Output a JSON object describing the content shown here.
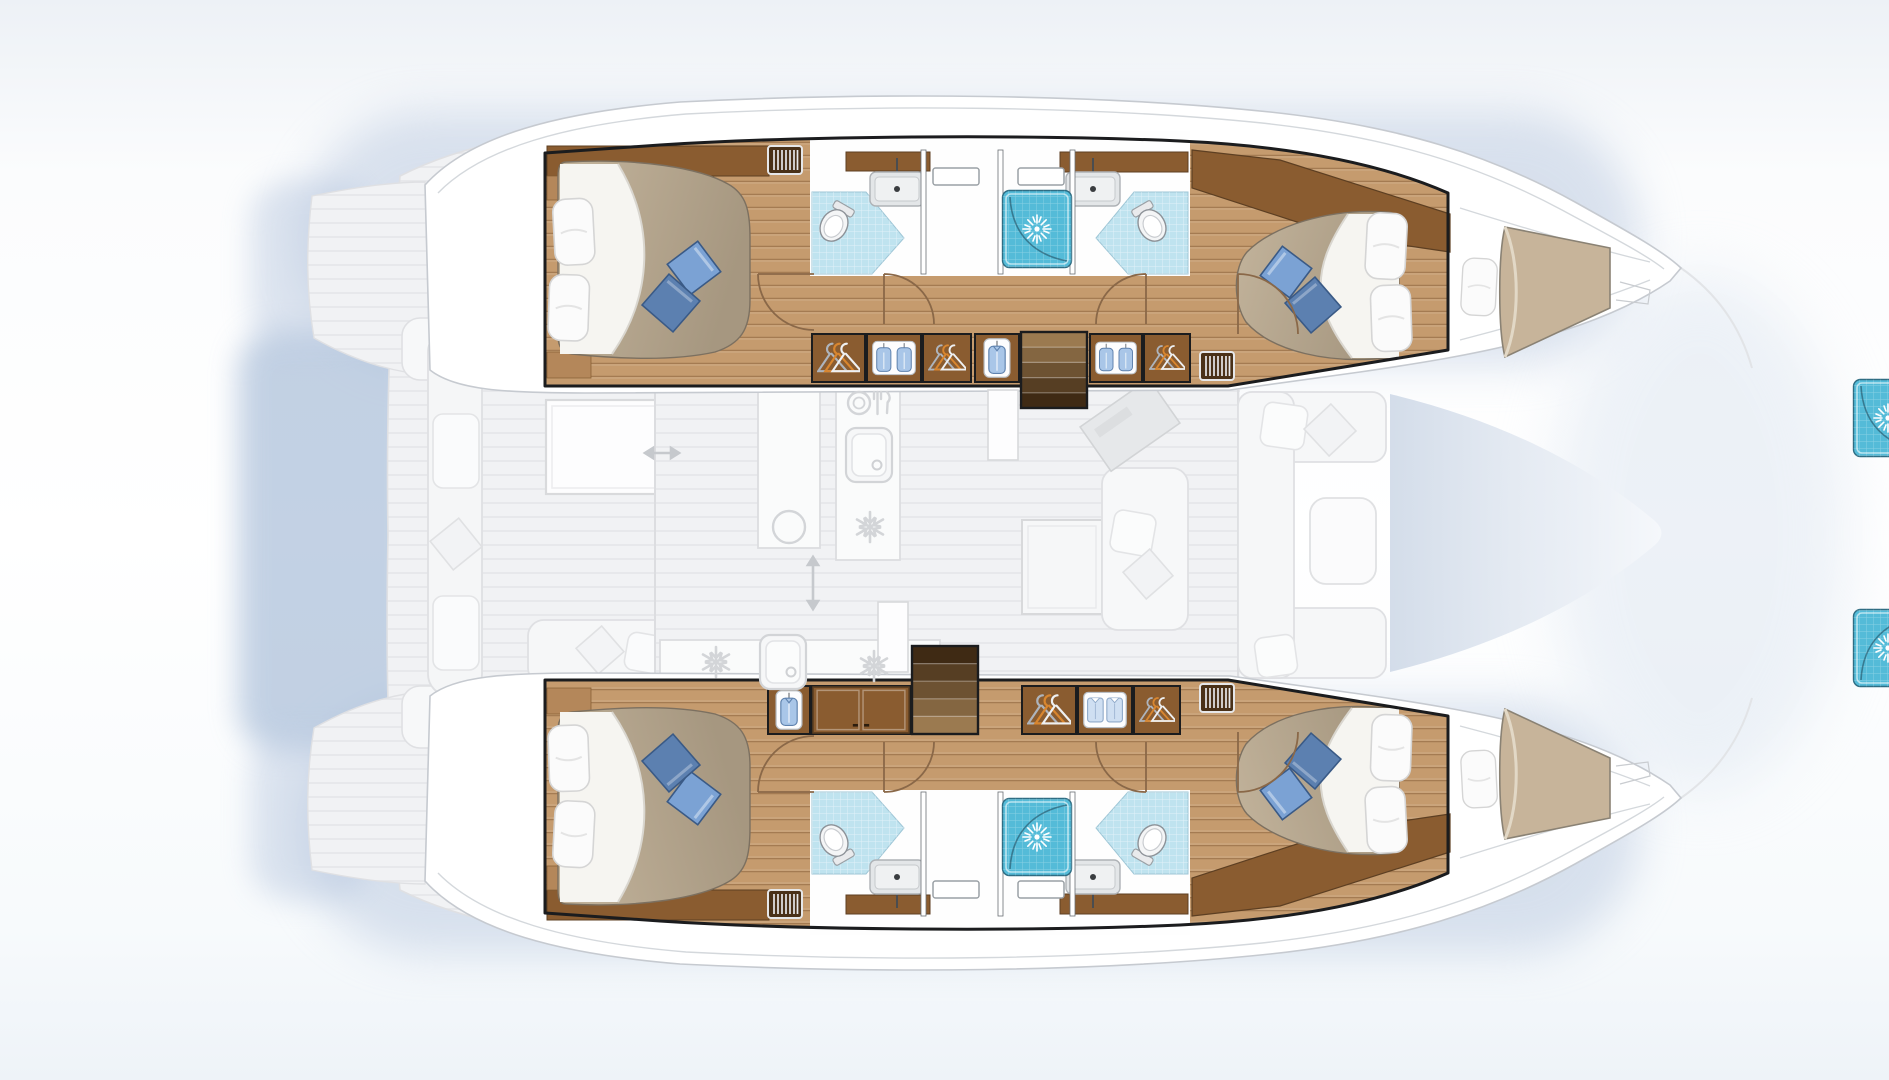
{
  "meta": {
    "canvas": {
      "w": 1889,
      "h": 1080
    }
  },
  "palette": {
    "outline": "#1b1c1e",
    "hull_white": "#ffffff",
    "hull_stroke": "#c6cad0",
    "deck_line": "#d4d8dc",
    "wood_floor": "#c59b6e",
    "wood_floor_line": "#8a5c30",
    "wood_furniture": "#8a5c30",
    "wood_dark": "#6b4526",
    "wood_deep": "#4a3118",
    "stair_light": "#9b7a50",
    "stair_dark": "#3f2a14",
    "tile_wc": "#bfe3ef",
    "tile_shower": "#54bbd8",
    "shower_edge": "#2f6d83",
    "bed_tan_1": "#c3b49c",
    "bed_tan_2": "#a69780",
    "bed_stroke": "#7c7060",
    "sheet_white": "#f6f5f1",
    "pillow_white": "#fbfbfb",
    "pillow_blue_1": "#7ba2d4",
    "pillow_blue_2": "#5c80b0",
    "pillow_blue_stroke": "#3a5a86",
    "fixture_white": "#f4f5f6",
    "fixture_gray": "#e3e6e8",
    "ghost_fill": "#f1f2f4",
    "ghost_line": "#dfe0e3",
    "ghost_icon": "#d3d5d8",
    "halo": "#b6c6de",
    "halo_deep": "#9fb6d4",
    "trampoline_blue": "#ccd7e6",
    "door_arc": "#8a6848"
  },
  "vessel": {
    "type": "catamaran-floor-plan",
    "hulls": [
      {
        "name": "port-hull",
        "rooms": [
          "aft-double-cabin",
          "aft-head-toilet-sink",
          "shower-1",
          "shower-2",
          "forward-head-toilet-sink",
          "forward-double-cabin",
          "forepeak-berth"
        ]
      },
      {
        "name": "starboard-hull",
        "rooms": [
          "aft-double-cabin",
          "aft-head-toilet-sink",
          "shower-1",
          "shower-2",
          "forward-head-toilet-sink",
          "forward-double-cabin",
          "forepeak-berth"
        ]
      }
    ],
    "deck_ghost": [
      "aft-cockpit-bench",
      "cockpit-table",
      "aft-sofa",
      "helm-seats",
      "saloon",
      "galley-island",
      "galley-aft-counter",
      "nav-station",
      "dining-table",
      "saloon-sofa",
      "forward-cockpit-sofa",
      "trampoline"
    ]
  },
  "features": {
    "locker_rows": [
      {
        "hull": "port",
        "y": 334,
        "h": 48,
        "sections": [
          {
            "x": 812,
            "w": 53,
            "icon": "hangers"
          },
          {
            "x": 867,
            "w": 54,
            "icon": "garments2"
          },
          {
            "x": 923,
            "w": 48,
            "icon": "hangers"
          },
          {
            "x": 975,
            "w": 44,
            "icon": "garment"
          },
          {
            "x": 1090,
            "w": 52,
            "icon": "garments2"
          },
          {
            "x": 1144,
            "w": 46,
            "icon": "hangers"
          }
        ]
      },
      {
        "hull": "starboard",
        "y": 686,
        "h": 48,
        "sections": [
          {
            "x": 768,
            "w": 42,
            "icon": "garment"
          },
          {
            "x": 812,
            "w": 98,
            "icon": "doors"
          },
          {
            "x": 1022,
            "w": 54,
            "icon": "hangers"
          },
          {
            "x": 1078,
            "w": 54,
            "icon": "shirts"
          },
          {
            "x": 1134,
            "w": 46,
            "icon": "hangers"
          }
        ]
      }
    ],
    "stairs": [
      {
        "x": 1021,
        "y": 332,
        "w": 66,
        "h": 76,
        "steps": 5,
        "dark": "end"
      },
      {
        "x": 912,
        "y": 646,
        "w": 66,
        "h": 88,
        "steps": 5,
        "dark": "start"
      }
    ],
    "stair_walls": [
      {
        "x": 988,
        "y": 390,
        "w": 30,
        "h": 70
      },
      {
        "x": 878,
        "y": 602,
        "w": 30,
        "h": 70
      }
    ],
    "vent_grilles": [
      {
        "x": 768,
        "y": 146
      },
      {
        "x": 1200,
        "y": 352
      },
      {
        "x": 768,
        "y": 890
      },
      {
        "x": 1200,
        "y": 684
      }
    ],
    "ghost_icons": [
      {
        "type": "plate-cutlery",
        "x": 866,
        "y": 403
      },
      {
        "type": "sink-square",
        "x": 869,
        "y": 455
      },
      {
        "type": "snowflake",
        "x": 870,
        "y": 527
      },
      {
        "type": "sink-round",
        "x": 789,
        "y": 527
      },
      {
        "type": "snowflake",
        "x": 716,
        "y": 662
      },
      {
        "type": "sink-square",
        "x": 783,
        "y": 662
      },
      {
        "type": "snowflake",
        "x": 874,
        "y": 666
      },
      {
        "type": "arrow-h",
        "x": 662,
        "y": 453,
        "len": 34
      },
      {
        "type": "arrow-v",
        "x": 813,
        "y": 583,
        "len": 52
      }
    ]
  }
}
